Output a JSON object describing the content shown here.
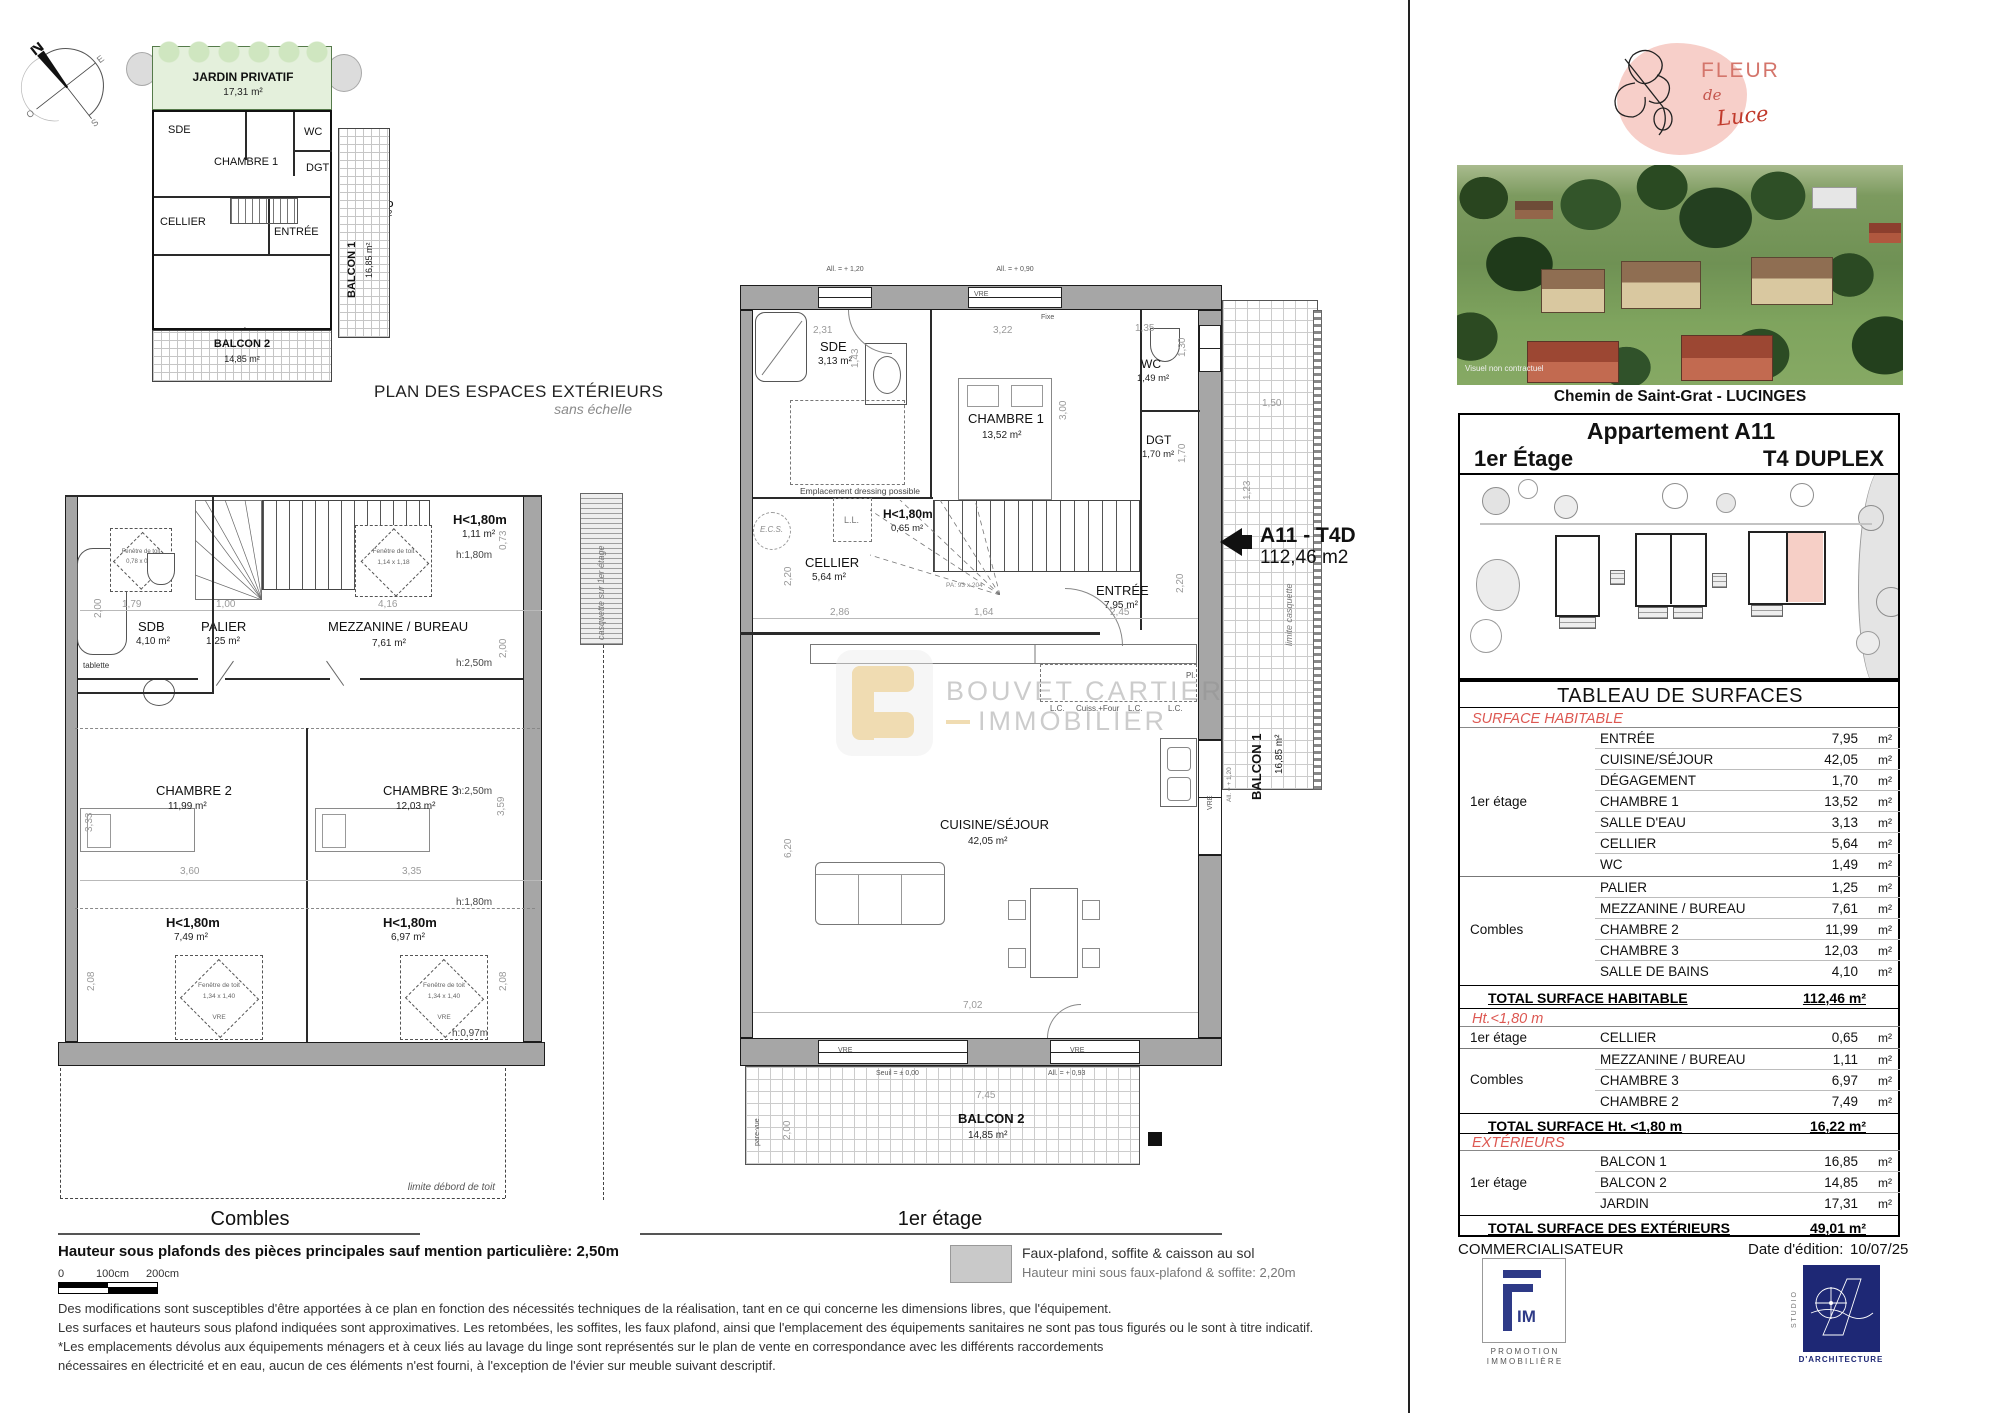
{
  "compass": {
    "n": "N",
    "e": "E",
    "s": "S",
    "o": "O"
  },
  "mini": {
    "jardin": "JARDIN PRIVATIF",
    "jardin_area": "17,31 m²",
    "sde": "SDE",
    "chambre1": "CHAMBRE 1",
    "wc": "WC",
    "dgt": "DGT",
    "cellier": "CELLIER",
    "entree": "ENTRÉE",
    "cuisine": "CUISINE/SÉJOUR",
    "unit": "A11 - T4D",
    "unit_area": "112,46 m2",
    "balcon1": "BALCON 1",
    "balcon1_area": "16,85 m²",
    "balcon2": "BALCON 2",
    "balcon2_area": "14,85 m²",
    "caption": "PLAN DES ESPACES EXTÉRIEURS",
    "caption_sub": "sans échelle"
  },
  "combles": {
    "title": "Combles",
    "sdb": "SDB",
    "sdb_area": "4,10 m²",
    "palier": "PALIER",
    "palier_area": "1,25 m²",
    "mezz": "MEZZANINE / BUREAU",
    "mezz_area": "7,61 m²",
    "ch2": "CHAMBRE 2",
    "ch2_area": "11,99 m²",
    "ch3": "CHAMBRE 3",
    "ch3_area": "12,03 m²",
    "h180_top": "H<1,80m",
    "h180_top_area": "1,11 m²",
    "h180_l": "H<1,80m",
    "h180_l_area": "7,49 m²",
    "h180_r": "H<1,80m",
    "h180_r_area": "6,97 m²",
    "note_h180": "h:1,80m",
    "note_h250a": "h:2,50m",
    "note_h250b": "h:2,50m",
    "note_h180b": "h:1,80m",
    "note_h097": "h:0,97m",
    "tablette": "tablette",
    "fen": "Fenêtre de toit",
    "fen_sdb_dim": "0,78 x 0,98",
    "fen_mezz_dim": "1,14 x 1,18",
    "fen_dim": "1,34 x 1,40",
    "vre": "VRE",
    "d_200a": "2,00",
    "d_179": "1,79",
    "d_100": "1,00",
    "d_416": "4,16",
    "d_073": "0,73",
    "d_200b": "2,00",
    "d_360": "3,60",
    "d_335": "3,35",
    "d_208a": "2,08",
    "d_208b": "2,08",
    "d_333": "3,33",
    "d_359": "3,59",
    "casquette": "casquette sur 1er étage",
    "limite": "limite débord de toit"
  },
  "etage": {
    "title": "1er étage",
    "sde": "SDE",
    "sde_area": "3,13 m²",
    "ch1": "CHAMBRE 1",
    "ch1_area": "13,52 m²",
    "wc": "WC",
    "wc_area": "1,49 m²",
    "dgt": "DGT",
    "dgt_area": "1,70 m²",
    "cellier": "CELLIER",
    "cellier_area": "5,64 m²",
    "entree": "ENTRÉE",
    "entree_area": "7,95 m²",
    "cuisine": "CUISINE/SÉJOUR",
    "cuisine_area": "42,05 m²",
    "h180": "H<1,80m",
    "h180_area": "0,65 m²",
    "balcon1": "BALCON 1",
    "balcon1_area": "16,85 m²",
    "balcon2": "BALCON 2",
    "balcon2_area": "14,85 m²",
    "unit": "A11 - T4D",
    "unit_area": "112,46 m2",
    "ecs": "E.C.S.",
    "ll": "L.L.",
    "lc1": "L.C.",
    "cuiss": "Cuiss.+Four",
    "lc2": "L.C.",
    "lc3": "L.C.",
    "pl": "Pl.",
    "pa": "PA:  93 x 204",
    "dressing": "Emplacement dressing possible",
    "all120": "All. = + 1,20",
    "all090": "All. = + 0,90",
    "all120v": "All. = + 1,20",
    "all093": "All. = + 0,93",
    "vre_a": "VRE",
    "fixe": "Fixe",
    "vre_door": "VRE",
    "vre_b": "VRE",
    "vre_c": "VRE",
    "seuil": "Seuil = ± 0,00",
    "parevue": "pare-vue",
    "limite_casquette": "limite casquette",
    "d_231": "2,31",
    "d_322": "3,22",
    "d_143": "1,43",
    "d_300": "3,00",
    "d_135": "1,35",
    "d_130": "1,30",
    "d_170": "1,70",
    "d_150": "1,50",
    "d_123": "1,23",
    "d_220a": "2,20",
    "d_220b": "2,20",
    "d_286": "2,86",
    "d_164": "1,64",
    "d_245": "2,45",
    "d_620": "6,20",
    "d_702": "7,02",
    "d_745": "7,45",
    "d_200": "2,00"
  },
  "watermark": {
    "line1": "BOUVET CARTIER",
    "line2": "IMMOBILIER"
  },
  "footer": {
    "note_bold": "Hauteur sous plafonds des pièces principales sauf mention particulière: 2,50m",
    "scale0": "0",
    "scale100": "100cm",
    "scale200": "200cm",
    "legend1": "Faux-plafond, soffite & caisson au sol",
    "legend2": "Hauteur mini sous faux-plafond & soffite: 2,20m",
    "disc1": "Des modifications sont susceptibles d'être apportées à ce plan en fonction des nécessités techniques de la réalisation, tant en ce qui concerne les dimensions libres, que l'équipement.",
    "disc2": "Les surfaces et hauteurs sous plafond indiquées sont approximatives. Les retombées, les soffites, les faux plafond, ainsi que l'emplacement des équipements sanitaires ne sont pas tous figurés ou le sont à titre indicatif.",
    "disc3": "*Les emplacements dévolus aux équipements ménagers et à ceux liés au lavage du linge sont représentés sur le plan de vente en correspondance avec les différents raccordements",
    "disc4": "nécessaires en électricité et en eau, aucun de ces éléments n'est fourni, à l'exception de l'évier sur meuble suivant descriptif."
  },
  "brand": {
    "fleur": "FLEUR",
    "de": "de",
    "luce": "Luce"
  },
  "panel": {
    "photo_caption": "Visuel non contractuel",
    "address": "Chemin de Saint-Grat - LUCINGES",
    "apt_title": "Appartement A11",
    "floor": "1er Étage",
    "type": "T4 DUPLEX",
    "table_title": "TABLEAU DE SURFACES",
    "sec1": "SURFACE HABITABLE",
    "sec2": "Ht.<1,80 m",
    "sec3": "EXTÉRIEURS",
    "unit": "m²",
    "g1": "1er étage",
    "g2": "Combles",
    "g3": "1er étage",
    "g4": "Combles",
    "g5": "1er étage",
    "rows": [
      {
        "label": "ENTRÉE",
        "v": "7,95"
      },
      {
        "label": "CUISINE/SÉJOUR",
        "v": "42,05"
      },
      {
        "label": "DÉGAGEMENT",
        "v": "1,70"
      },
      {
        "label": "CHAMBRE 1",
        "v": "13,52"
      },
      {
        "label": "SALLE D'EAU",
        "v": "3,13"
      },
      {
        "label": "CELLIER",
        "v": "5,64"
      },
      {
        "label": "WC",
        "v": "1,49"
      },
      {
        "label": "PALIER",
        "v": "1,25"
      },
      {
        "label": "MEZZANINE / BUREAU",
        "v": "7,61"
      },
      {
        "label": "CHAMBRE 2",
        "v": "11,99"
      },
      {
        "label": "CHAMBRE 3",
        "v": "12,03"
      },
      {
        "label": "SALLE DE BAINS",
        "v": "4,10"
      },
      {
        "label": "CELLIER",
        "v": "0,65"
      },
      {
        "label": "MEZZANINE / BUREAU",
        "v": "1,11"
      },
      {
        "label": "CHAMBRE 3",
        "v": "6,97"
      },
      {
        "label": "CHAMBRE 2",
        "v": "7,49"
      },
      {
        "label": "BALCON 1",
        "v": "16,85"
      },
      {
        "label": "BALCON 2",
        "v": "14,85"
      },
      {
        "label": "JARDIN",
        "v": "17,31"
      }
    ],
    "tot1_label": "TOTAL SURFACE HABITABLE",
    "tot1_value": "112,46 m²",
    "tot2_label": "TOTAL SURFACE Ht. <1,80 m",
    "tot2_value": "16,22 m²",
    "tot3_label": "TOTAL SURFACE  DES EXTÉRIEURS",
    "tot3_value": "49,01 m²",
    "commercialisateur": "COMMERCIALISATEUR",
    "date_label": "Date d'édition:",
    "date_value": "10/07/25",
    "fim_im": "IM",
    "fim_l1": "P R O M O T I O N",
    "fim_l2": "I M M O B I L I È R E",
    "studio_v": "S T U D I O",
    "studio_l": "D'ARCHITECTURE"
  },
  "colors": {
    "accent_red": "#dd5852",
    "pink_unit": "#f6cfc6",
    "navy": "#27317e",
    "gold": "#dfb257",
    "jardin_green": "#e4f0dc"
  }
}
